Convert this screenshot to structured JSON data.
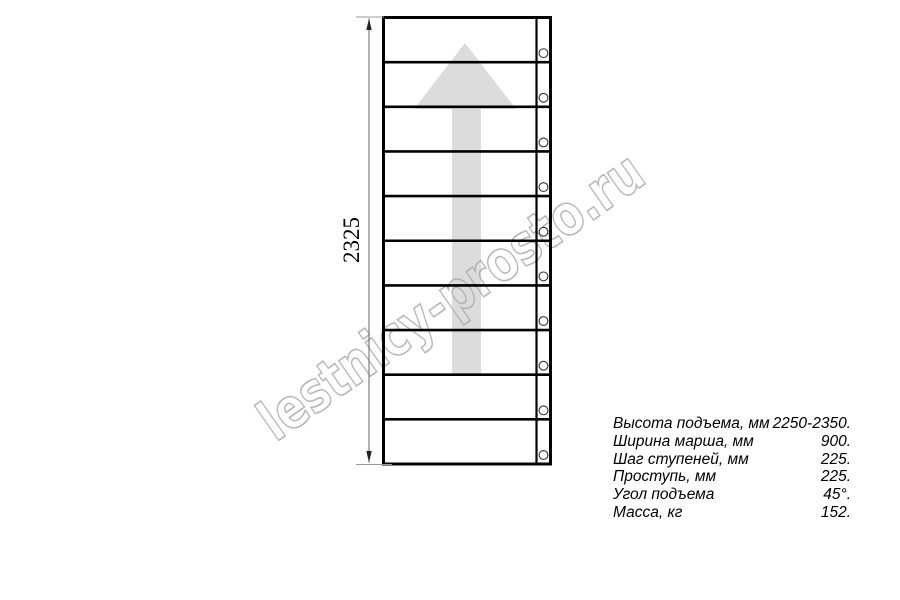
{
  "watermark": {
    "text": "lestnicy-prosto.ru",
    "color": "#ababab"
  },
  "drawing": {
    "dimension_label": "2325",
    "steps_count": 10,
    "holes_count": 10,
    "line_color": "#000000",
    "arrow_color": "#dcdcdc",
    "dim_line_color": "#666666"
  },
  "specs": {
    "rows": [
      {
        "label": "Высота подъема, мм",
        "value": "2250-2350."
      },
      {
        "label": "Ширина марша, мм",
        "value": "900."
      },
      {
        "label": "Шаг ступеней, мм",
        "value": "225."
      },
      {
        "label": "Проступь, мм",
        "value": "225."
      },
      {
        "label": "Угол подъема",
        "value": "45°."
      },
      {
        "label": "Масса, кг",
        "value": "152."
      }
    ]
  }
}
